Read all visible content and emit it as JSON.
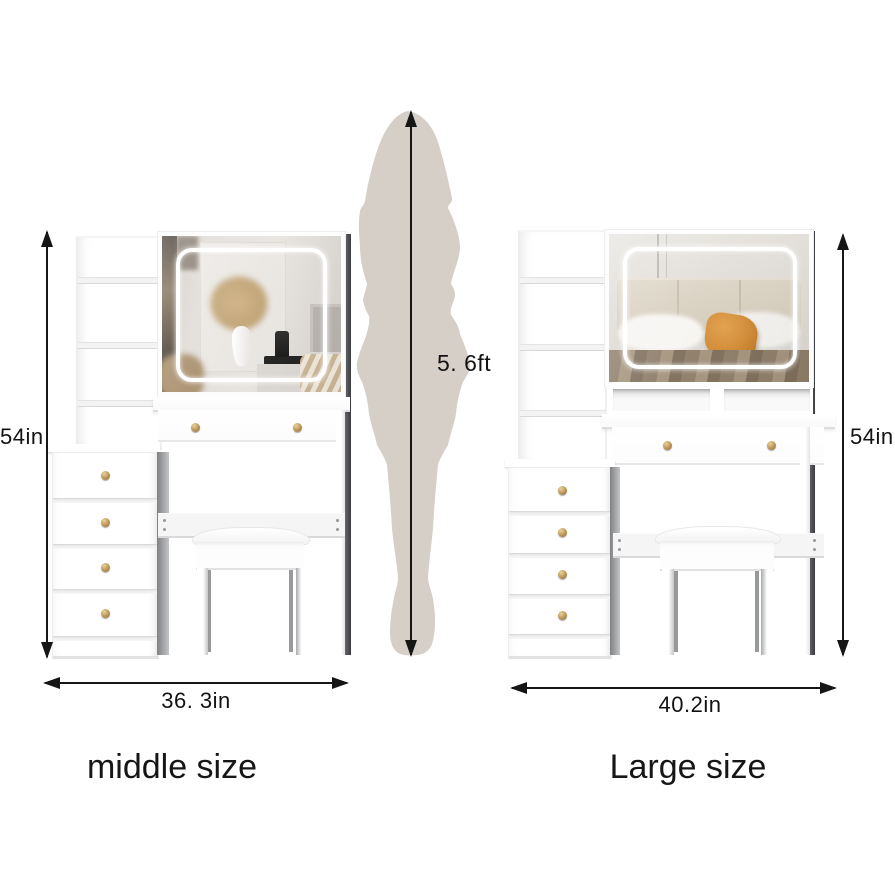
{
  "products": [
    {
      "id": "middle",
      "name": "middle size",
      "width": "36. 3in",
      "height": "54in"
    },
    {
      "id": "large",
      "name": "Large size",
      "width": "40.2in",
      "height": "54in"
    }
  ],
  "person": {
    "height": "5. 6ft",
    "icon": "person-silhouette"
  },
  "colors": {
    "silhouette": "#d5cfc8",
    "arrow": "#161616",
    "knob_gold": "#bb9455",
    "furniture_white": "#ffffff",
    "led_ring": "#ffffff",
    "pillow_orange": "#d28a33",
    "blanket_brown": "#8d7d68"
  }
}
